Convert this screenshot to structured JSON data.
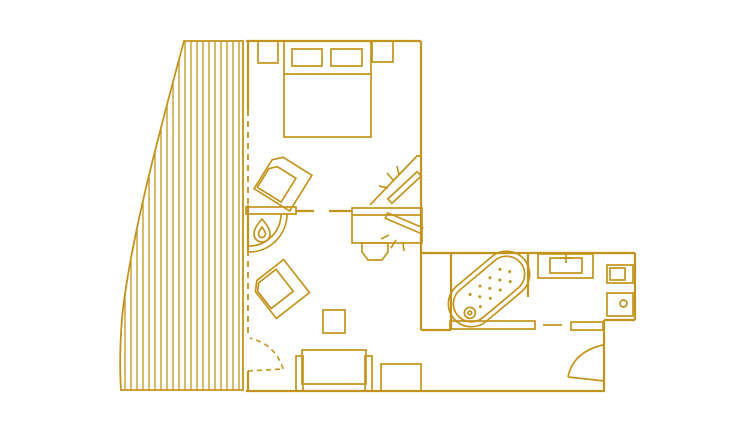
{
  "plan": {
    "type": "floor-plan-line-drawing",
    "background": "#ffffff",
    "line_color": "#c3941d",
    "areas": [
      "terrace",
      "bedroom",
      "living-area",
      "bathroom",
      "entry"
    ],
    "elements": [
      "terrace-deck-planks",
      "terrace-curved-edge",
      "terrace-door-swing",
      "window-glazing-dashed",
      "double-bed",
      "pillow-left",
      "pillow-right",
      "nightstand-left",
      "nightstand-right",
      "armchair-upper",
      "armchair-lower",
      "fireplace-with-flame",
      "tv-console",
      "bedroom-tv-with-rays",
      "living-room-tv-with-rays",
      "desk-chair",
      "side-table",
      "sofa",
      "bench",
      "bathtub-with-drain",
      "washbasin-with-tap",
      "toilet-cistern",
      "toilet-bowl",
      "bathroom-ledge",
      "towel-rail",
      "entry-door-swing"
    ]
  }
}
